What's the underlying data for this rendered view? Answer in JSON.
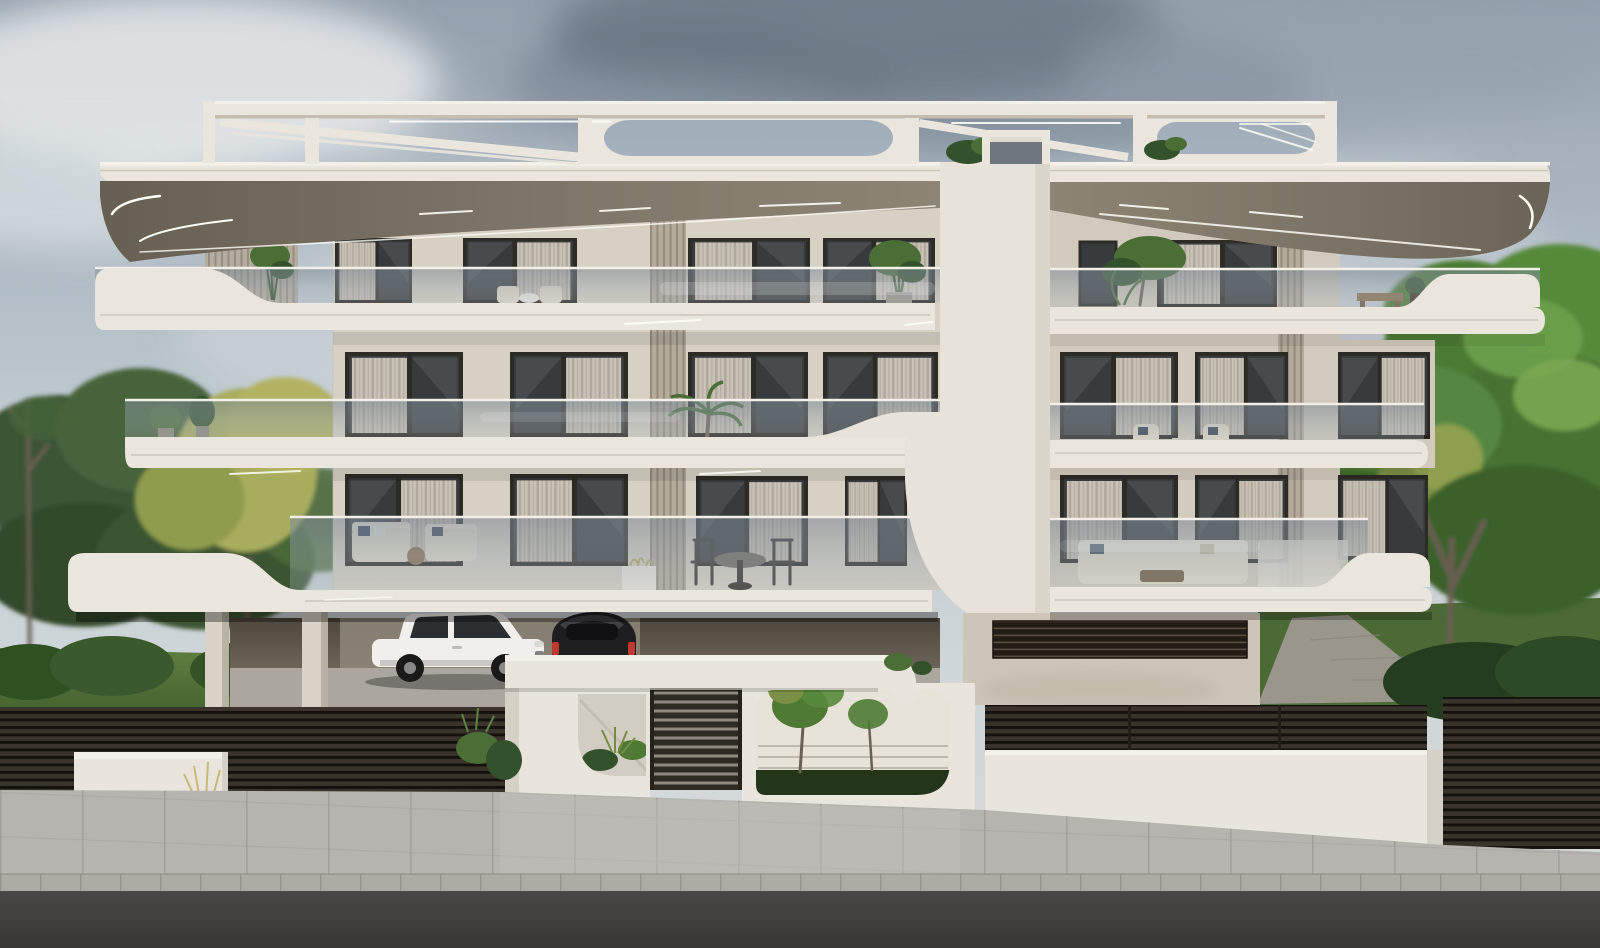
{
  "scene": {
    "type": "architectural-exterior-render",
    "subject": "modern three-storey apartment building, front elevation, overcast sky",
    "building": {
      "floors": 3,
      "features": [
        "rooftop pergola frame with diagonal braces and rounded openings",
        "deep cantilevered roof slabs with recessed LED strip lighting",
        "curved wave-edged white balcony slabs",
        "frameless glass balustrades",
        "central curved white spine",
        "vertical louver privacy screens",
        "dark horizontal-slat boundary fences",
        "entrance wall with canopy, slatted gate and planted cut-out windows",
        "open carport on pilotis"
      ]
    },
    "vehicles": [
      {
        "name": "white-suv"
      },
      {
        "name": "black-hatchback"
      }
    ],
    "vegetation": [
      "left garden trees",
      "right garden trees",
      "balcony potted plants",
      "front lawns",
      "gate planters"
    ],
    "ground": [
      "paved driveway",
      "tiled sidewalk",
      "stone curb",
      "asphalt road"
    ]
  },
  "palette": {
    "skyTop": "#93a0ad",
    "cloudDark": "#5e6d7c",
    "cloudLight": "#e6e9ea",
    "creamBright": "#eae6dd",
    "cream": "#dcd6ca",
    "creamShade": "#c5beb0",
    "wall": "#d7d1c4",
    "wallShade": "#c6bfb1",
    "wallRight": "#d2cbbd",
    "spine": "#e7e3da",
    "spineShade": "#cfc9bc",
    "glassCap": "#f1efe7",
    "frame": "#2d2b26",
    "winGlass": "#383b3d",
    "curtain": "#c9c2b6",
    "curtainDark": "#b0a89b",
    "louver": "#b4ab9d",
    "louverLine": "#948b7d",
    "ventBg": "#221c15",
    "ventLine": "#5a4f41",
    "fenceBg": "#15120e",
    "fenceSlat": "#39332b",
    "whiteWall": "#e9e5dc",
    "whiteWallShade": "#d6d1c6",
    "sidewalk": "#b6b4af",
    "sidewalkJoint": "#a19f9a",
    "curb": "#adaba4",
    "grass": "#5d7c3e",
    "grassDark": "#41602e",
    "treeGreen": "#4e7a33",
    "treeLight": "#6da14b",
    "treeDark": "#2f5122",
    "treeYellow": "#a8ad5d",
    "treeOlive": "#7b8f45",
    "trunk": "#6a5f52",
    "pave": "#aba79f",
    "carWhite": "#f0efeb",
    "carBlack": "#1e1e21",
    "tailRed": "#c0392f",
    "plantGreen": "#4a6e35",
    "plantDark": "#33512a",
    "furnBeige": "#e3dcca",
    "wood": "#8a6f4e",
    "chairDark": "#332f2a",
    "led": "#fdfdf6"
  }
}
